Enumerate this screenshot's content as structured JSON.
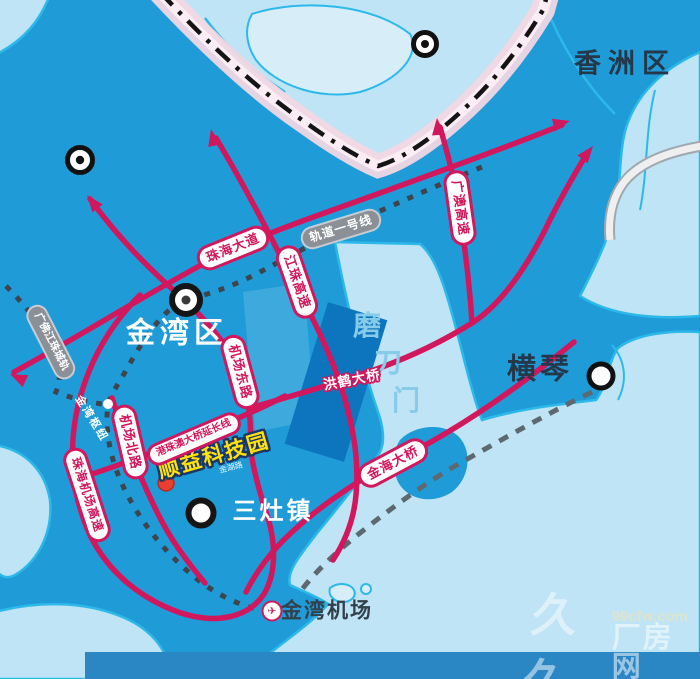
{
  "map": {
    "regions": {
      "xiangzhou": "香洲区",
      "jinwan": "金湾区",
      "hengqin": "横琴",
      "sanzao": "三灶镇",
      "modaomen_chars": [
        "磨",
        "刀",
        "门"
      ]
    },
    "roads": {
      "zhuhai_avenue": "珠海大道",
      "jiangzhu_expwy": "江珠高速",
      "guangao_expwy": "广澳高速",
      "airport_east_rd": "机场东路",
      "airport_north_rd": "机场北路",
      "airport_expwy": "珠海机场高速",
      "hzmb_extension": "港珠澳大桥延长线",
      "jinhai_bridge": "金海大桥",
      "honghe_bridge": "洪鹤大桥",
      "jinhu_road": "金湖路"
    },
    "rails": {
      "line1": "轨道一号线",
      "gfjz_intercity": "广佛江珠城轨"
    },
    "pois": {
      "tech_park": "顺益科技园",
      "jinwan_hub": "金湾枢纽",
      "jinwan_airport": "金湾机场"
    },
    "icons": {
      "airport_icon": "✈"
    }
  },
  "watermark": {
    "logo": "久久",
    "site": "99cfw.com",
    "name": "厂房网"
  },
  "colors": {
    "water_base": "#1F9CD8",
    "land_light": "#BEE4F5",
    "land_lighter": "#D7EEF9",
    "coast_stroke": "#2CB9EA",
    "road_red": "#D3175C",
    "rail_pill_gray": "#8A9096",
    "boundary_pink": "#F2D7E3",
    "highlight_yellow": "#FFE20A",
    "reclaim_dark_blue": "#0D74BE"
  }
}
